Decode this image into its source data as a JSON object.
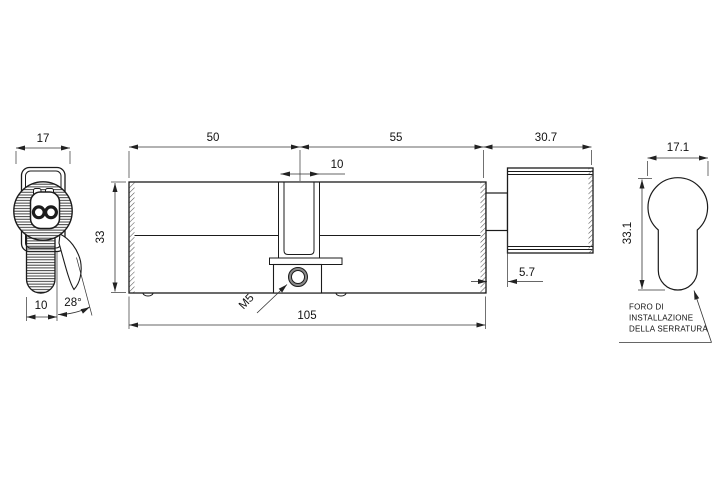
{
  "drawing": {
    "front_view": {
      "knob_diameter": "17",
      "stem_width": "10",
      "lever_angle": "28°"
    },
    "side_view": {
      "left_length": "50",
      "right_length": "55",
      "thumbturn_length": "30.7",
      "cam_slot_width": "10",
      "body_height": "33",
      "total_length": "105",
      "neck_length": "5.7",
      "thread_label": "M5"
    },
    "end_view": {
      "hole_width": "17.1",
      "hole_height": "33.1",
      "note_line1": "FORO DI",
      "note_line2": "INSTALLAZIONE",
      "note_line3": "DELLA SERRATURA"
    }
  },
  "colors": {
    "line": "#1b1b1b",
    "background": "#ffffff"
  }
}
